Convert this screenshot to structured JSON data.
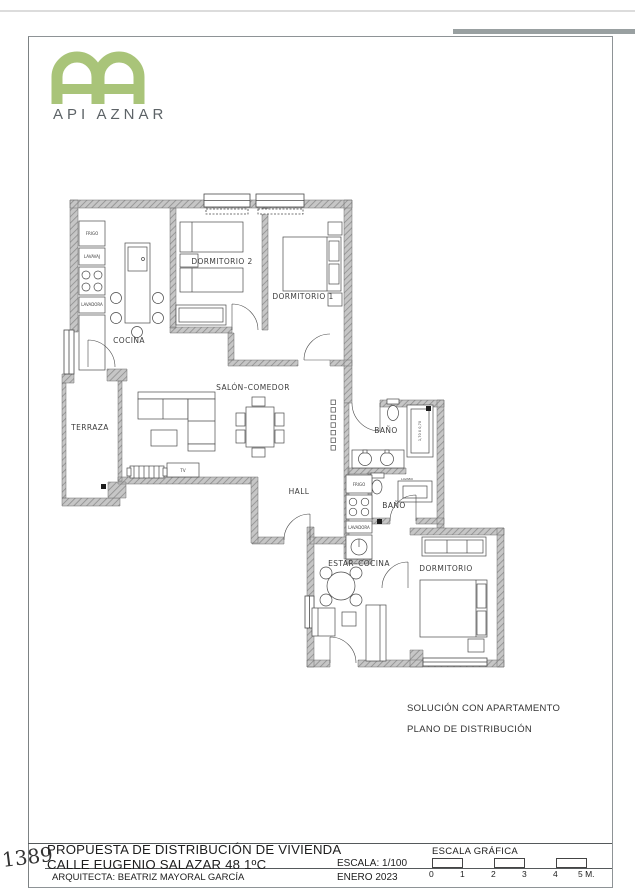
{
  "brand": {
    "name": "API AZNAR",
    "monogram": "AA",
    "green": "#a9c479",
    "text_color": "#5d6367"
  },
  "page_number": "1389",
  "plan": {
    "rooms": {
      "cocina": "COCINA",
      "dormitorio2": "DORMITORIO 2",
      "dormitorio1": "DORMITORIO 1",
      "terraza": "TERRAZA",
      "salon": "SALÓN–COMEDOR",
      "hall": "HALL",
      "bano1": "BAÑO",
      "bano2": "BAÑO",
      "estar_cocina": "ESTAR–COCINA",
      "dormitorio": "DORMITORIO"
    },
    "labels": {
      "frigo1": "FRIGO",
      "lavavajillas": "LAVAVAJ",
      "lavadora1": "LAVADORA",
      "frigo2": "FRIGO",
      "lavadora2": "LAVADORA",
      "tv": "TV",
      "lavabo": "LAVABO",
      "shower_dim": "1,70 X 0,70"
    }
  },
  "notes": {
    "line1": "SOLUCIÓN CON APARTAMENTO",
    "line2": "PLANO DE DISTRIBUCIÓN"
  },
  "titleblock": {
    "title_line1": "PROPUESTA DE DISTRIBUCIÓN DE VIVIENDA",
    "title_line2": "CALLE EUGENIO SALAZAR 48 1ºC",
    "scale_label": "ESCALA: 1/100",
    "architect": "ARQUITECTA: BEATRIZ MAYORAL GARCÍA",
    "date": "ENERO 2023",
    "scalebar": {
      "title": "ESCALA GRÁFICA",
      "ticks": [
        "0",
        "1",
        "2",
        "3",
        "4",
        "5 M."
      ]
    }
  }
}
